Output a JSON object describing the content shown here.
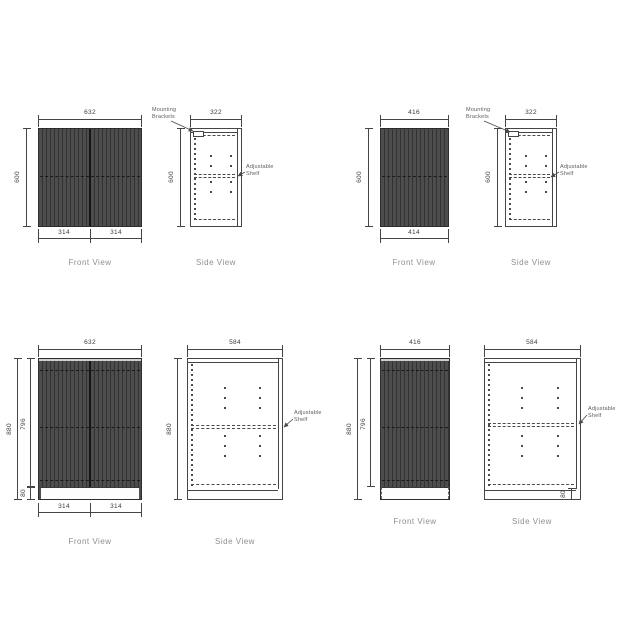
{
  "page": {
    "background": "#ffffff"
  },
  "colors": {
    "line": "#454545",
    "cabinet_base": "#4d4d4d",
    "cabinet_stripe": "#323232",
    "dim_text": "#3d3d3d",
    "view_label_text": "#8f8f8f",
    "annotation_text": "#5c5c5c"
  },
  "panels": [
    {
      "name": "wall-cabinet-632",
      "front": {
        "label": "Front View",
        "width_dim": "632",
        "height_dim": "600",
        "door_dims": [
          "314",
          "314"
        ]
      },
      "side": {
        "label": "Side View",
        "depth_dim": "322",
        "height_dim": "600",
        "mounting_label": "Mounting Brackets",
        "shelf_label": "Adjustable Shelf"
      }
    },
    {
      "name": "wall-cabinet-416",
      "front": {
        "label": "Front View",
        "width_dim": "416",
        "height_dim": "600",
        "door_dims": [
          "414"
        ]
      },
      "side": {
        "label": "Side View",
        "depth_dim": "322",
        "height_dim": "600",
        "mounting_label": "Mounting Brackets",
        "shelf_label": "Adjustable Shelf"
      }
    },
    {
      "name": "base-cabinet-632",
      "front": {
        "label": "Front View",
        "width_dim": "632",
        "height_dim": "880",
        "door_height_dim": "796",
        "kick_dim": "80",
        "door_dims": [
          "314",
          "314"
        ]
      },
      "side": {
        "label": "Side View",
        "depth_dim": "584",
        "height_dim": "880",
        "shelf_label": "Adjustable Shelf"
      }
    },
    {
      "name": "base-cabinet-416",
      "front": {
        "label": "Front View",
        "width_dim": "416",
        "height_dim": "880",
        "door_height_dim": "796"
      },
      "side": {
        "label": "Side View",
        "depth_dim": "584",
        "kick_dim": "80",
        "shelf_label": "Adjustable Shelf"
      }
    }
  ]
}
